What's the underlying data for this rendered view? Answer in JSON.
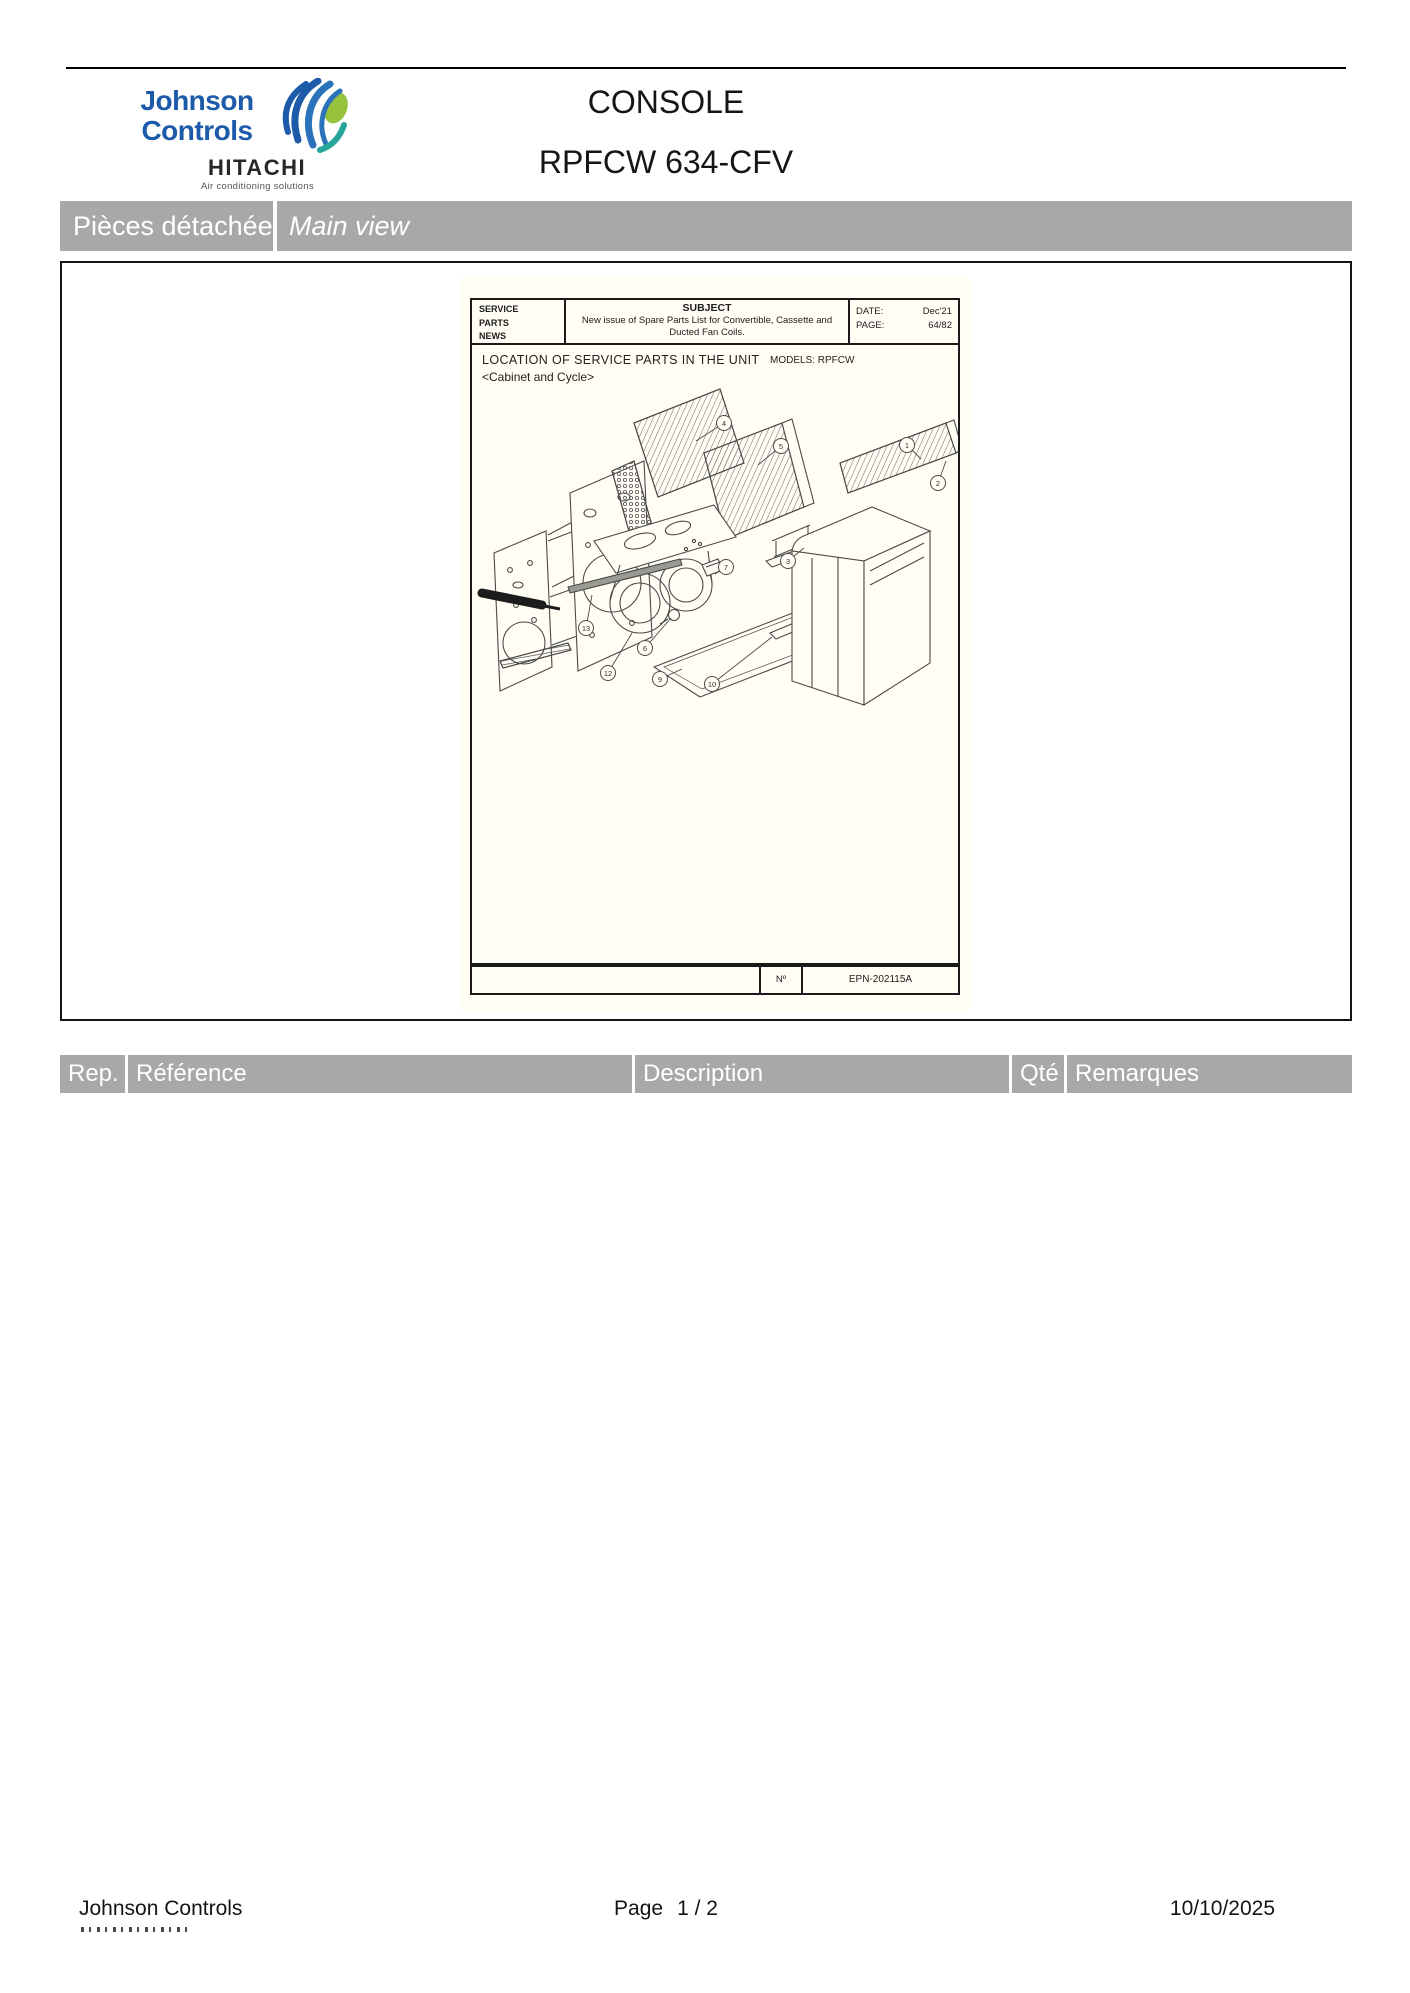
{
  "colors": {
    "bar_gray": "#a8a8a8",
    "jc_blue": "#1d5aa9",
    "hitachi_dark": "#26262b",
    "leaf_green": "#97c23c",
    "teal": "#27a59a",
    "paper": "#fffdf4"
  },
  "header": {
    "logo_line1": "Johnson",
    "logo_line2": "Controls",
    "sub_brand": "HITACHI",
    "sub_tagline": "Air conditioning solutions",
    "title": "CONSOLE",
    "subtitle": "RPFCW 634-CFV"
  },
  "section_bar": {
    "left": "Pièces détachées",
    "right": "Main view"
  },
  "document": {
    "masthead": {
      "label": "SERVICE\nPARTS\nNEWS",
      "subject_title": "SUBJECT",
      "subject_body": "New issue of Spare Parts List for Convertible, Cassette and Ducted Fan Coils.",
      "date_label": "DATE:",
      "date_value": "Dec'21",
      "page_label": "PAGE:",
      "page_value": "64/82"
    },
    "location_title": "LOCATION OF SERVICE PARTS IN THE UNIT",
    "location_subtitle": "<Cabinet and Cycle>",
    "models_text": "MODELS:  RPFCW",
    "doc_footer": {
      "no_label": "Nº",
      "doc_number": "EPN-202115A"
    },
    "callouts": [
      {
        "n": "4",
        "x": 252,
        "y": 78,
        "tx": 224,
        "ty": 96
      },
      {
        "n": "5",
        "x": 309,
        "y": 101,
        "tx": 286,
        "ty": 120
      },
      {
        "n": "1",
        "x": 435,
        "y": 100,
        "tx": 449,
        "ty": 114
      },
      {
        "n": "2",
        "x": 466,
        "y": 138,
        "tx": 474,
        "ty": 116
      },
      {
        "n": "3",
        "x": 316,
        "y": 216,
        "tx": 332,
        "ty": 203
      },
      {
        "n": "7",
        "x": 254,
        "y": 222,
        "tx": 243,
        "ty": 229
      },
      {
        "n": "13",
        "x": 114,
        "y": 283,
        "tx": 120,
        "ty": 250
      },
      {
        "n": "12",
        "x": 136,
        "y": 328,
        "tx": 160,
        "ty": 288
      },
      {
        "n": "6",
        "x": 173,
        "y": 303,
        "tx": 199,
        "ty": 273
      },
      {
        "n": "9",
        "x": 188,
        "y": 334,
        "tx": 210,
        "ty": 324
      },
      {
        "n": "10",
        "x": 240,
        "y": 339,
        "tx": 300,
        "ty": 292
      }
    ]
  },
  "parts_table": {
    "columns": [
      "Rep.",
      "Référence",
      "Description",
      "Qté",
      "Remarques"
    ]
  },
  "page_footer": {
    "company": "Johnson Controls",
    "page_label": "Page",
    "page_value": "1  / 2",
    "date": "10/10/2025"
  }
}
